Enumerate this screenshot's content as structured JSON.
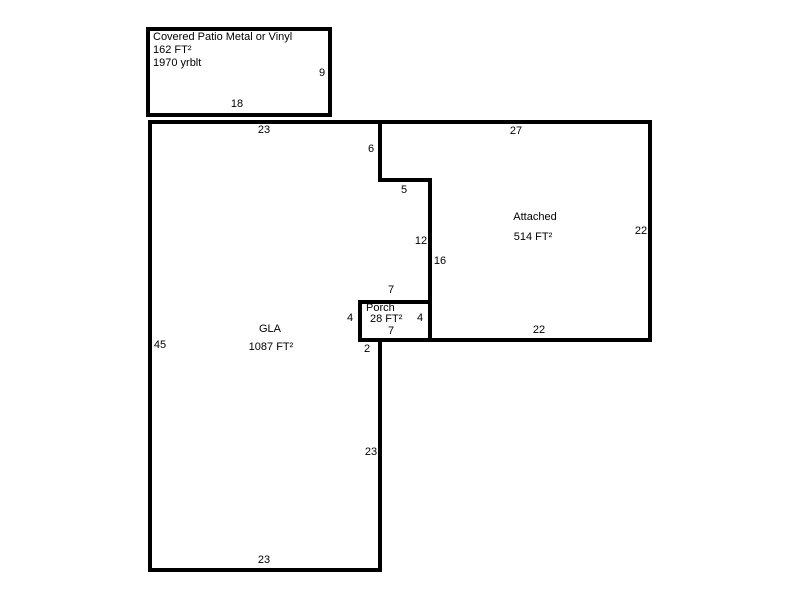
{
  "sketch": {
    "colors": {
      "background": "#ffffff",
      "line": "#000000",
      "text": "#000000"
    },
    "patio": {
      "title": "Covered Patio Metal or Vinyl",
      "area": "162 FT²",
      "yrblt": "1970 yrblt",
      "dim_right": "9",
      "dim_bottom": "18"
    },
    "gla": {
      "title": "GLA",
      "area": "1087 FT²",
      "dim_top": "23",
      "dim_left": "45",
      "dim_bottom": "23",
      "dim_right_lower": "23",
      "dim_step_height": "6",
      "dim_step_width": "5",
      "dim_right_mid": "12",
      "dim_notch": "2"
    },
    "attached": {
      "title": "Attached",
      "area": "514 FT²",
      "dim_top": "27",
      "dim_right": "22",
      "dim_bottom": "22",
      "dim_left": "16"
    },
    "porch": {
      "title": "Porch",
      "area": "28 FT²",
      "dim_top": "7",
      "dim_bottom": "7",
      "dim_left": "4",
      "dim_right": "4"
    }
  }
}
